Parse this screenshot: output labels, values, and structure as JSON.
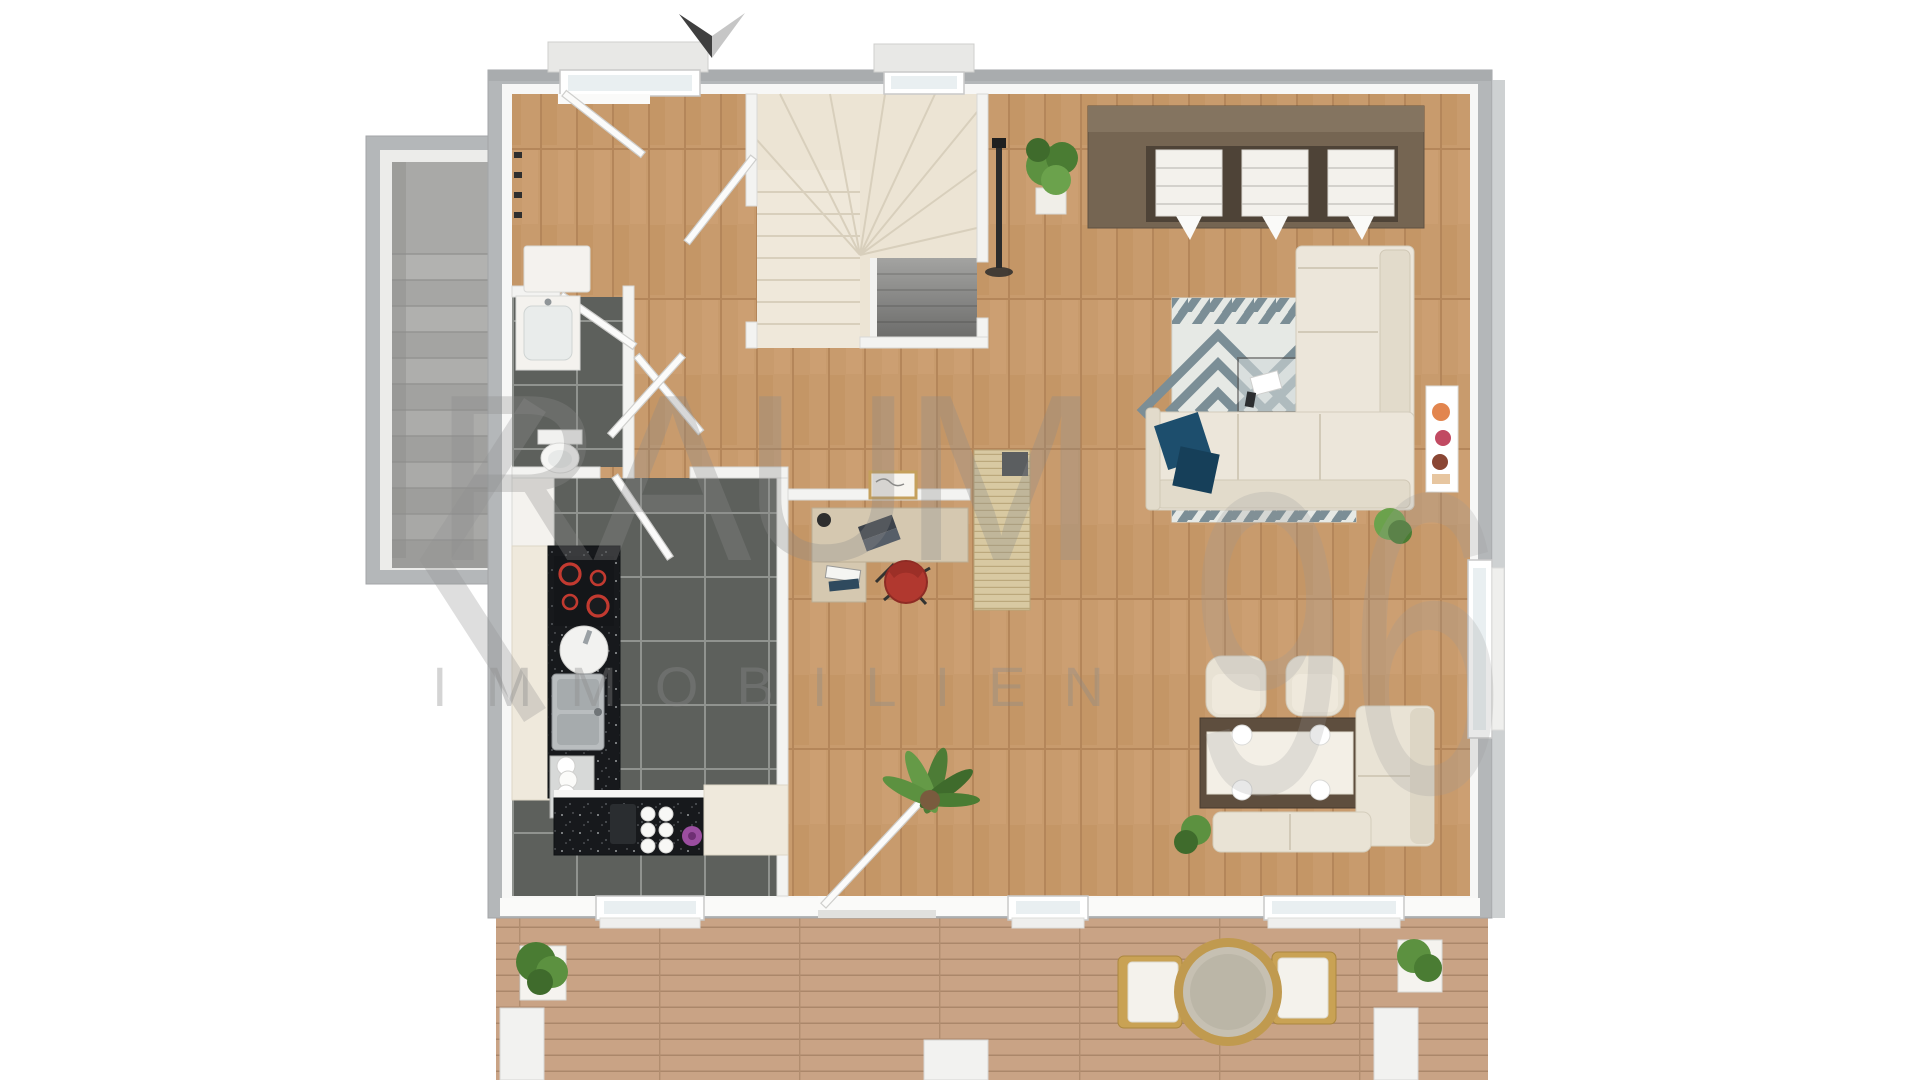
{
  "watermark": {
    "bracket": "‹",
    "brand": "RAUM",
    "number": "96",
    "subtitle": "IMMOBILIEN"
  },
  "compass": {
    "type": "north-arrow",
    "orientation": "pointing-down"
  },
  "palette": {
    "background": "#ffffff",
    "exterior_wall": "#b4b7b9",
    "interior_wall": "#f3f3f1",
    "wood_floor": "#c89b6d",
    "tile_floor": "#5d605c",
    "deck_wood": "#c9a385",
    "counter_granite": "#17191c",
    "cabinet_cream": "#efe9dc",
    "sofa_cream": "#ece6da",
    "rug_accent": "#7b8e96",
    "pillow_blue": "#1d4e6d",
    "wardrobe_wood": "#756552",
    "office_chair_red": "#b1382f",
    "hob_burner_red": "#c23a30",
    "plant_green": "#5c9140",
    "stair_cream": "#ece4d4",
    "stair_gray": "#a3a3a1",
    "watermark_gray": "#8b8b8b"
  },
  "floorplan": {
    "view": "3d-top-down-render",
    "rooms": [
      {
        "name": "entrance-hall",
        "floor": "wood",
        "features": [
          "front-door",
          "door-canopy-window",
          "coat-hooks",
          "sideboard"
        ]
      },
      {
        "name": "staircase",
        "floor": "stairs",
        "features": [
          "winder-stairs-up",
          "basement-stairs-down",
          "landing-window"
        ]
      },
      {
        "name": "wc",
        "floor": "dark-tile",
        "features": [
          "washbasin",
          "toilet"
        ]
      },
      {
        "name": "kitchen",
        "floor": "dark-tile",
        "features": [
          "tall-cabinet",
          "hob-red-burners",
          "round-sink",
          "double-sink",
          "dish-rack",
          "mugs",
          "purple-flower",
          "kitchen-window"
        ]
      },
      {
        "name": "home-office-nook",
        "floor": "wood",
        "features": [
          "l-desk",
          "laptop",
          "desk-lamp",
          "books",
          "red-office-chair",
          "wall-picture",
          "slat-partition"
        ]
      },
      {
        "name": "living-dining-room",
        "floor": "wood",
        "features": [
          "wardrobe-unit",
          "floor-lamp",
          "potted-plant",
          "corner-sofa",
          "blue-pillows",
          "geometric-rug",
          "coffee-table",
          "wall-art",
          "side-window",
          "palm-plant",
          "dining-table",
          "table-runner",
          "plates",
          "dining-chairs",
          "corner-bench",
          "terrace-door"
        ]
      },
      {
        "name": "terrace",
        "floor": "deck",
        "features": [
          "planter-left",
          "planter-right",
          "round-rattan-table",
          "rattan-chair-left",
          "rattan-chair-right"
        ]
      },
      {
        "name": "exterior-staircase",
        "floor": "concrete-steps",
        "features": [
          "landing"
        ]
      }
    ]
  }
}
